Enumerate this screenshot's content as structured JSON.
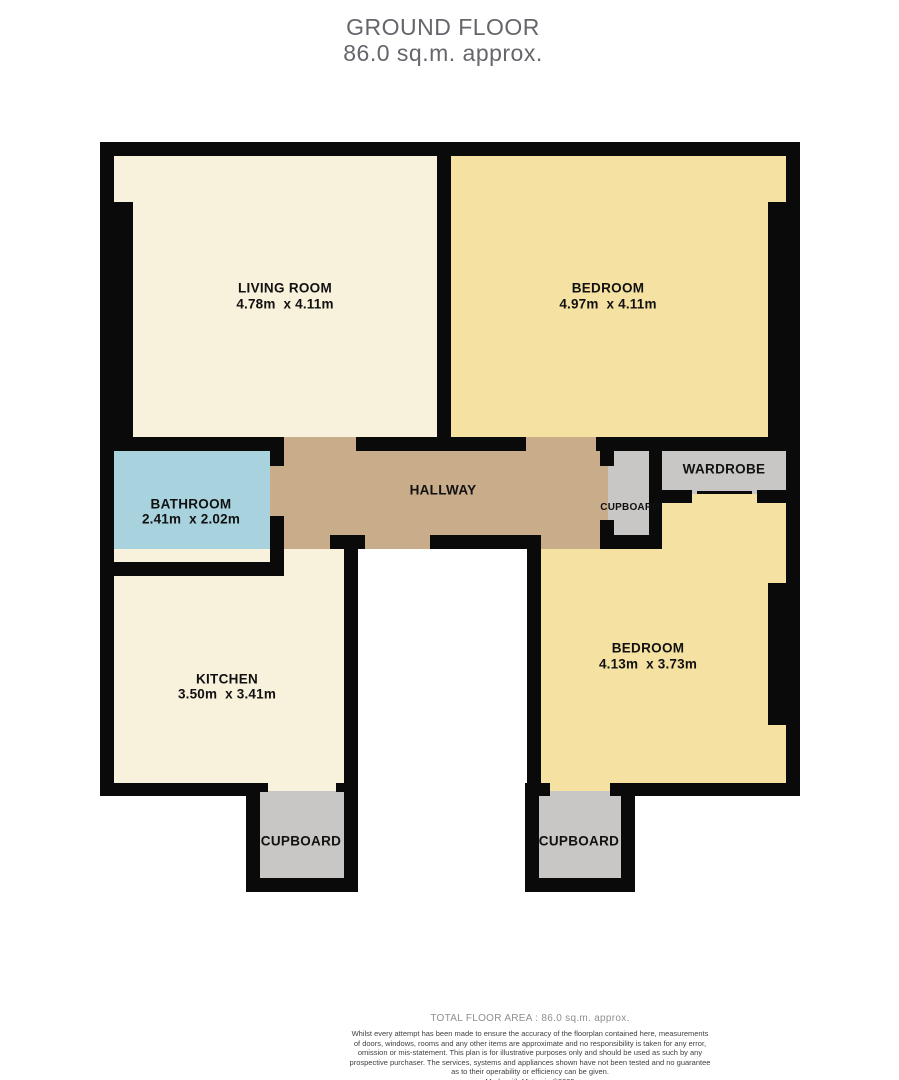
{
  "title": {
    "line1": "GROUND FLOOR",
    "line2": "86.0 sq.m. approx."
  },
  "rooms": {
    "living_room": {
      "name": "LIVING ROOM",
      "dims": "4.78m  x 4.11m"
    },
    "bedroom_top": {
      "name": "BEDROOM",
      "dims": "4.97m  x 4.11m"
    },
    "bathroom": {
      "name": "BATHROOM",
      "dims": "2.41m  x 2.02m"
    },
    "hallway": {
      "name": "HALLWAY"
    },
    "wardrobe": {
      "name": "WARDROBE"
    },
    "cupboard_hall": {
      "name": "CUPBOARD"
    },
    "kitchen": {
      "name": "KITCHEN",
      "dims": "3.50m  x 3.41m"
    },
    "bedroom_bottom": {
      "name": "BEDROOM",
      "dims": "4.13m  x 3.73m"
    },
    "cupboard_kitchen": {
      "name": "CUPBOARD"
    },
    "cupboard_bedroom": {
      "name": "CUPBOARD"
    }
  },
  "footer": {
    "total_area": "TOTAL FLOOR AREA : 86.0 sq.m. approx.",
    "disclaimer": "Whilst every attempt has been made to ensure the accuracy of the floorplan contained here, measurements of doors, windows, rooms and any other items are approximate and no responsibility is taken for any error, omission or mis-statement. This plan is for illustrative purposes only and should be used as such by any prospective purchaser. The services, systems and appliances shown have not been tested and no guarantee as to their operability or efficiency can be given.",
    "credit": "Made with Metropix ©2025"
  },
  "colors": {
    "wall": "#0a0a0a",
    "living_kitchen_floor": "#f8f1db",
    "bedroom_floor": "#f5e2a2",
    "bathroom_floor": "#a8d3de",
    "hallway_floor": "#c9ad8b",
    "storage_floor": "#c8c7c5",
    "title_text": "#65656c",
    "footer_total_text": "#8f8f8f",
    "footer_disclaimer_text": "#3f3f3f",
    "room_label_text": "#111111"
  }
}
